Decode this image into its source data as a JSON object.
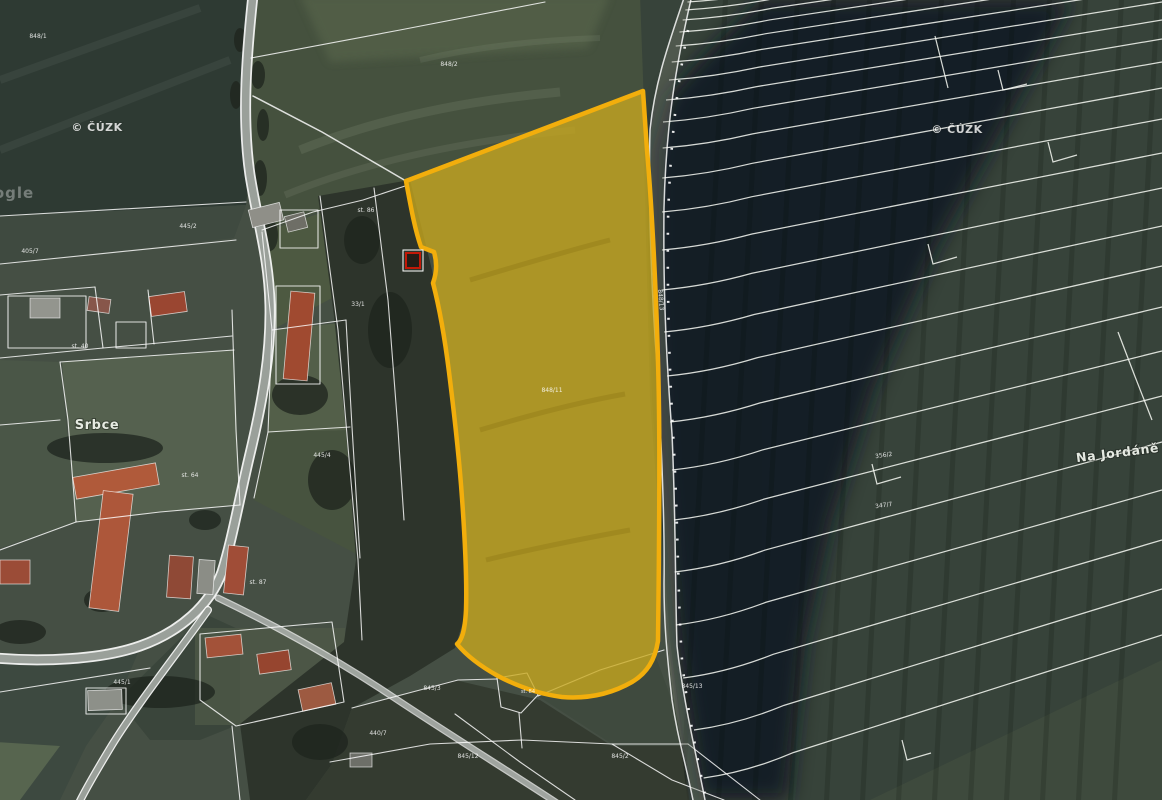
{
  "map": {
    "highlight": {
      "fill": "#c9a91e",
      "stroke": "#f2ae0c",
      "parcel_label": "848/11"
    },
    "colors": {
      "field_dark": "#2e3a33",
      "field_mid": "#37433a",
      "village_green": "#454f44",
      "shadow": "#101420",
      "road": "#9aa09a",
      "boundary": "#ffffff",
      "red_marker": "#c21807"
    },
    "labels": [
      {
        "t": "Srbce",
        "x": 97,
        "y": 429,
        "s": 13,
        "cls": "place"
      },
      {
        "t": "Na Jordáně",
        "x": 1118,
        "y": 457,
        "s": 12.5,
        "r": -7,
        "cls": "place"
      },
      {
        "t": "© ČÚZK",
        "x": 97,
        "y": 131,
        "s": 11,
        "cls": "wm"
      },
      {
        "t": "© ČÚZK",
        "x": 957,
        "y": 133,
        "s": 11,
        "cls": "wm"
      },
      {
        "t": "ogle",
        "x": 14,
        "y": 198,
        "s": 15,
        "cls": "goo"
      },
      {
        "t": "848/1",
        "x": 38,
        "y": 38
      },
      {
        "t": "848/2",
        "x": 449,
        "y": 66
      },
      {
        "t": "st. 86",
        "x": 366,
        "y": 212
      },
      {
        "t": "445/2",
        "x": 188,
        "y": 228
      },
      {
        "t": "405/7",
        "x": 30,
        "y": 253
      },
      {
        "t": "33/1",
        "x": 358,
        "y": 306
      },
      {
        "t": "st. 40",
        "x": 80,
        "y": 348
      },
      {
        "t": "848/11",
        "x": 552,
        "y": 392,
        "o": 0.7
      },
      {
        "t": "445/4",
        "x": 322,
        "y": 457
      },
      {
        "t": "st. 64",
        "x": 190,
        "y": 477
      },
      {
        "t": "st. 87",
        "x": 258,
        "y": 584
      },
      {
        "t": "445/1",
        "x": 122,
        "y": 684
      },
      {
        "t": "845/3",
        "x": 432,
        "y": 690
      },
      {
        "t": "st. 84",
        "x": 528,
        "y": 693,
        "s": 5
      },
      {
        "t": "440/7",
        "x": 378,
        "y": 735
      },
      {
        "t": "845/12",
        "x": 468,
        "y": 758
      },
      {
        "t": "845/2",
        "x": 620,
        "y": 758
      },
      {
        "t": "845/13",
        "x": 692,
        "y": 688
      },
      {
        "t": "848/13",
        "x": 659,
        "y": 300,
        "r": 85
      },
      {
        "t": "356/2",
        "x": 884,
        "y": 457,
        "r": -8
      },
      {
        "t": "347/7",
        "x": 884,
        "y": 507,
        "r": -8
      }
    ]
  }
}
